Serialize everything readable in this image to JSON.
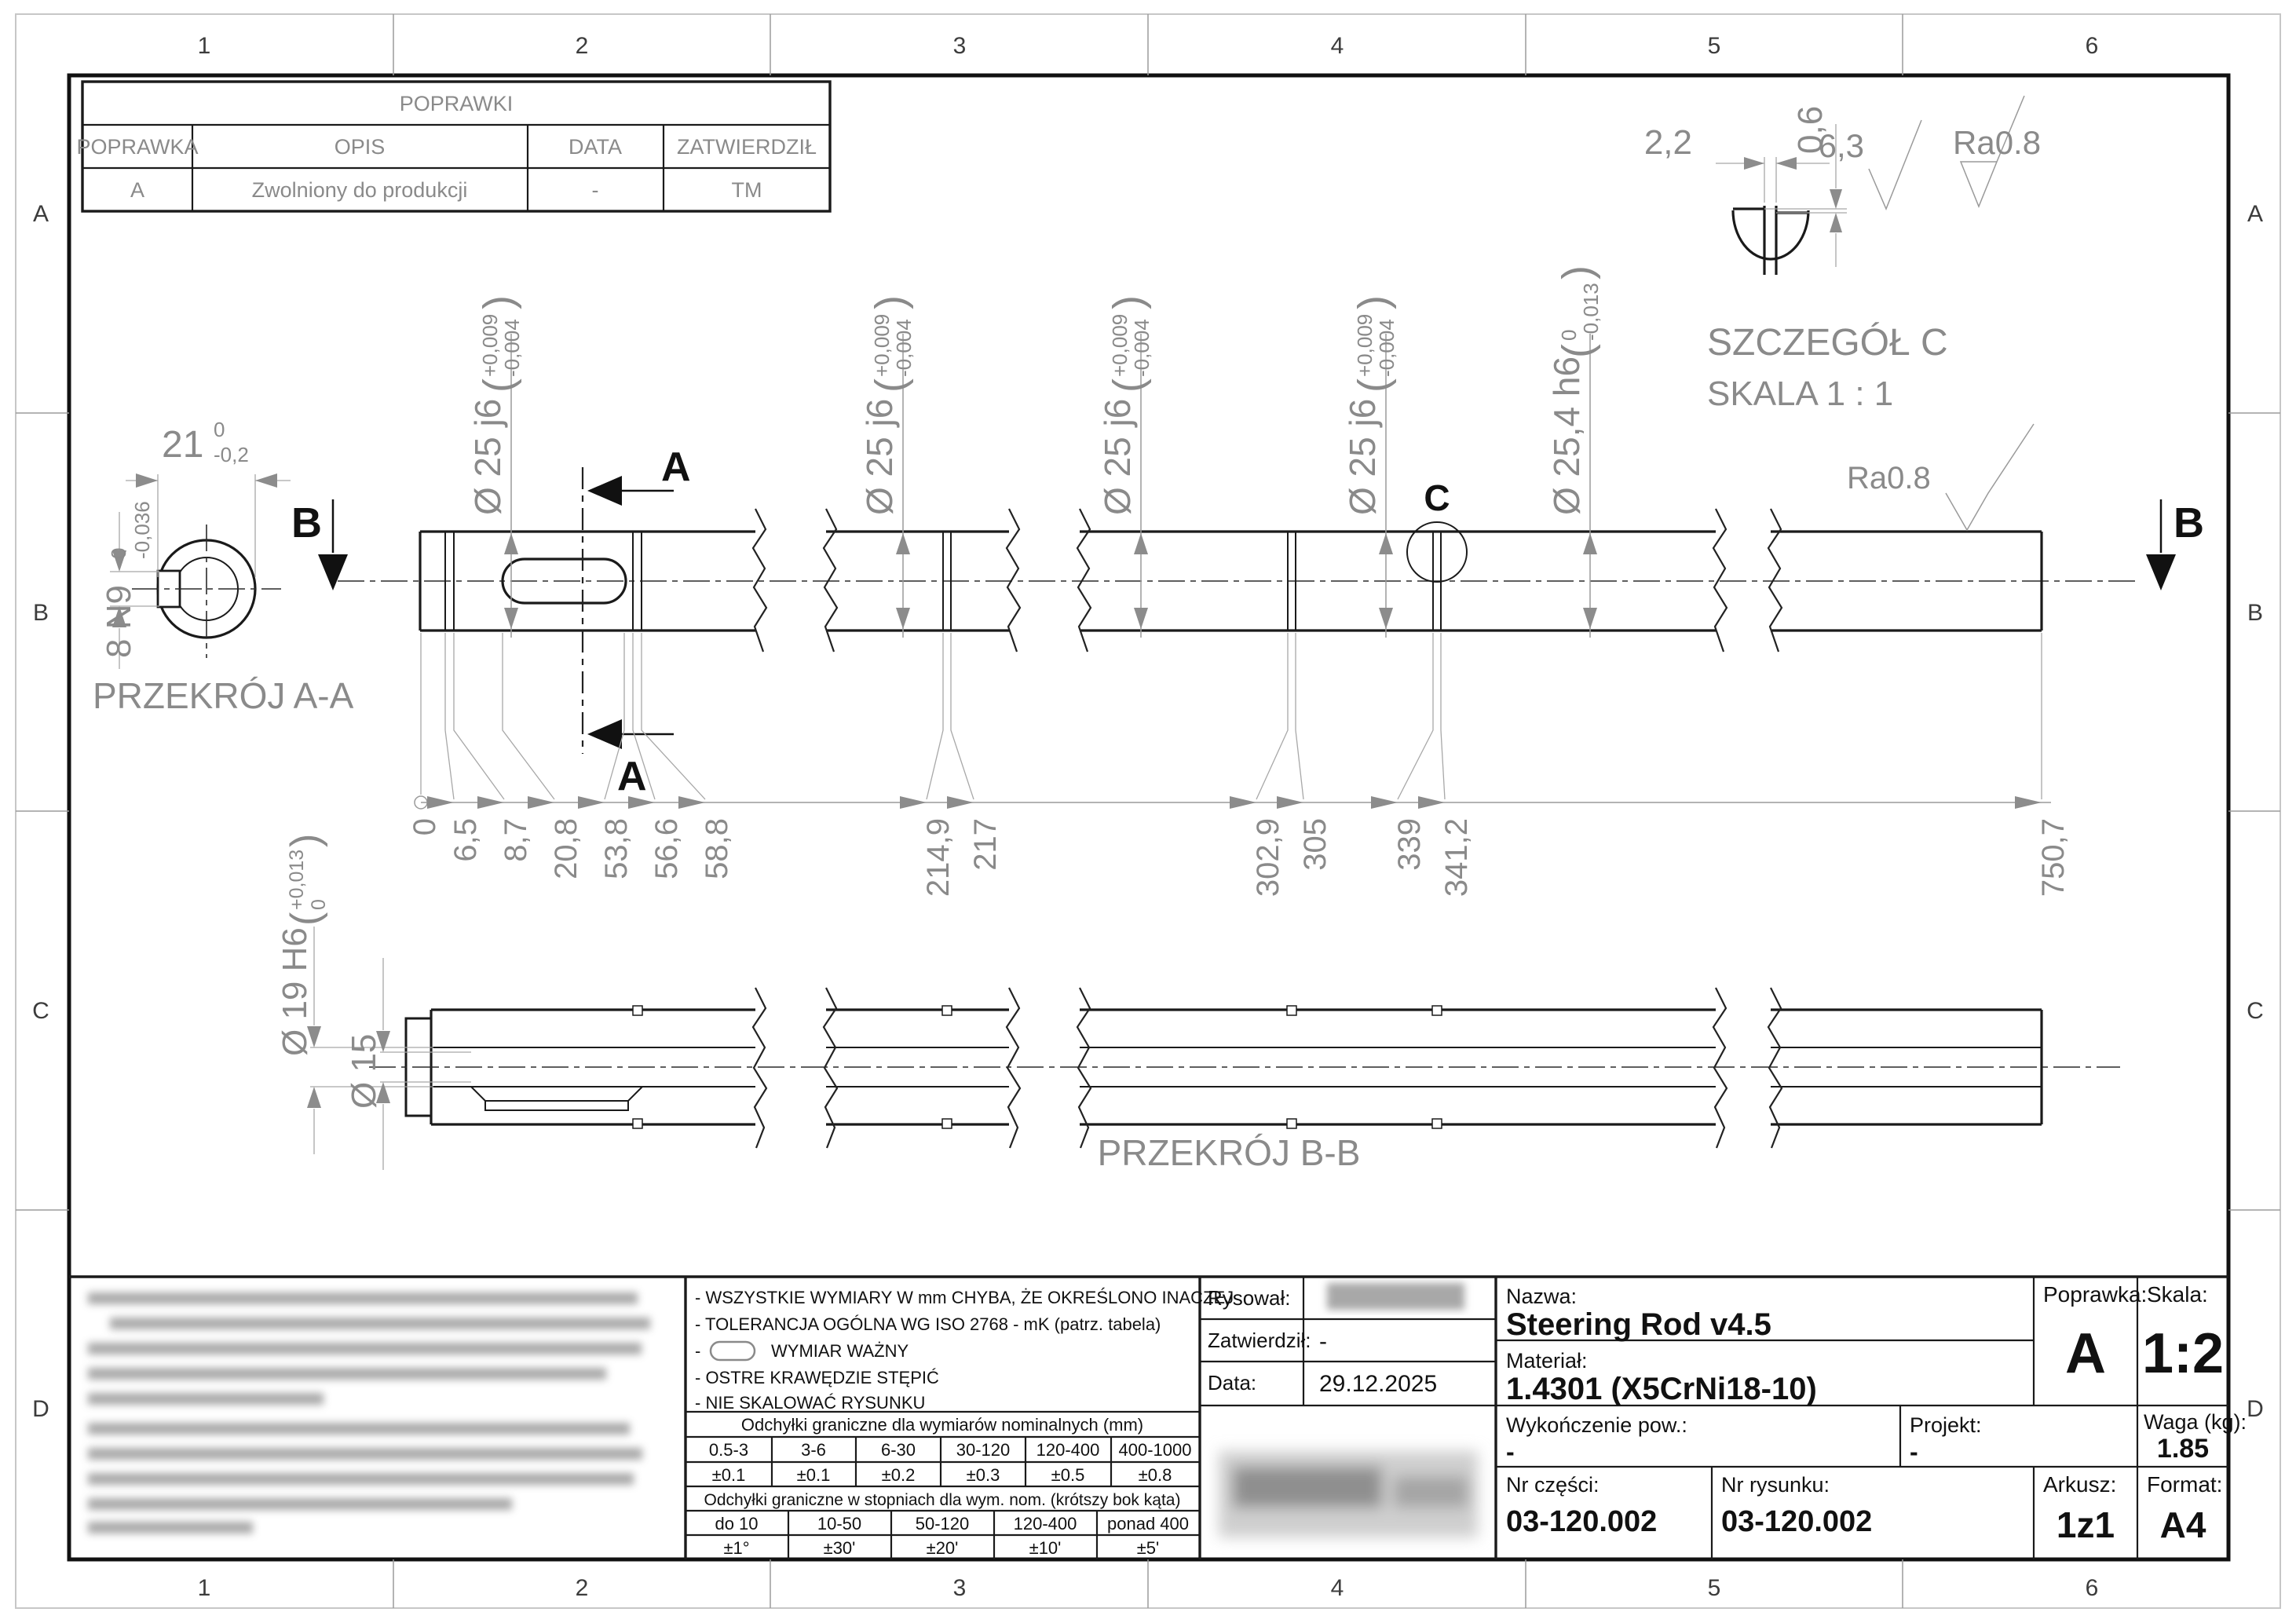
{
  "zones": {
    "columns": [
      "1",
      "2",
      "3",
      "4",
      "5",
      "6"
    ],
    "rows": [
      "A",
      "B",
      "C",
      "D"
    ]
  },
  "revision_table": {
    "title": "POPRAWKI",
    "col_poprawka": "POPRAWKA",
    "col_opis": "OPIS",
    "col_data": "DATA",
    "col_zatwierdzil": "ZATWIERDZIŁ",
    "row": {
      "poprawka": "A",
      "opis": "Zwolniony do produkcji",
      "data": "-",
      "zatwierdzil": "TM"
    }
  },
  "main_view": {
    "dia25": {
      "label": "Ø 25 j6",
      "tol_top": "+0,009",
      "tol_bottom": "-0,004"
    },
    "dia254": {
      "label": "Ø 25,4 h6",
      "tol_top": "0",
      "tol_bottom": "-0,013"
    },
    "surface_ra": "Ra0.8",
    "cut_label_a": "A",
    "cut_label_b": "B",
    "detail_marker": "C",
    "ordinate": [
      "0",
      "6,5",
      "8,7",
      "20,8",
      "53,8",
      "56,6",
      "58,8",
      "214,9",
      "217",
      "302,9",
      "305",
      "339",
      "341,2",
      "750,7"
    ]
  },
  "section_aa": {
    "title": "PRZEKRÓJ A-A",
    "width": {
      "nominal": "21",
      "tol_top": "0",
      "tol_bottom": "-0,2"
    },
    "keyway": {
      "nominal": "8 N9",
      "tol_top": "0",
      "tol_bottom": "-0,036"
    }
  },
  "section_bb": {
    "title": "PRZEKRÓJ B-B",
    "bore": {
      "label": "Ø 19 H6",
      "tol_top": "+0,013",
      "tol_bottom": "0"
    },
    "inner": "Ø 15"
  },
  "detail_c": {
    "title": "SZCZEGÓŁ C",
    "scale": "SKALA 1 : 1",
    "slot_width": "2,2",
    "step_depth": "0,6",
    "roughness_general": "6,3",
    "roughness_fine": "Ra0.8"
  },
  "notes": {
    "line1": "- WSZYSTKIE WYMIARY W mm CHYBA, ŻE OKREŚLONO INACZEJ",
    "line2": "- TOLERANCJA OGÓLNA WG   ISO 2768 - mK (patrz. tabela)",
    "line3_prefix": "-",
    "line3": "WYMIAR WAŻNY",
    "line4": "- OSTRE KRAWĘDZIE STĘPIĆ",
    "line5": "- NIE SKALOWAĆ RYSUNKU"
  },
  "tolerance_table": {
    "header_mm": "Odchyłki graniczne dla wymiarów nominalnych (mm)",
    "ranges_mm": [
      "0.5-3",
      "3-6",
      "6-30",
      "30-120",
      "120-400",
      "400-1000"
    ],
    "values_mm": [
      "±0.1",
      "±0.1",
      "±0.2",
      "±0.3",
      "±0.5",
      "±0.8"
    ],
    "header_deg": "Odchyłki graniczne w stopniach dla wym. nom. (krótszy bok kąta)",
    "ranges_deg": [
      "do 10",
      "10-50",
      "50-120",
      "120-400",
      "ponad 400"
    ],
    "values_deg": [
      "±1°",
      "±30'",
      "±20'",
      "±10'",
      "±5'"
    ]
  },
  "title_block": {
    "rysowal_label": "Rysował:",
    "zatwierdzil_label": "Zatwierdził:",
    "zatwierdzil_value": "-",
    "data_label": "Data:",
    "data_value": "29.12.2025",
    "nazwa_label": "Nazwa:",
    "nazwa_value": "Steering Rod v4.5",
    "material_label": "Materiał:",
    "material_value": "1.4301 (X5CrNi18-10)",
    "poprawka_label": "Poprawka:",
    "poprawka_value": "A",
    "skala_label": "Skala:",
    "skala_value": "1:2",
    "wykonczenie_label": "Wykończenie pow.:",
    "wykonczenie_value": "-",
    "projekt_label": "Projekt:",
    "projekt_value": "-",
    "waga_label": "Waga (kg):",
    "waga_value": "1.85",
    "nr_czesci_label": "Nr części:",
    "nr_czesci_value": "03-120.002",
    "nr_rysunku_label": "Nr rysunku:",
    "nr_rysunku_value": "03-120.002",
    "arkusz_label": "Arkusz:",
    "arkusz_value": "1z1",
    "format_label": "Format:",
    "format_value": "A4"
  },
  "symbols": {
    "paren_open": "(",
    "paren_close": ")"
  }
}
